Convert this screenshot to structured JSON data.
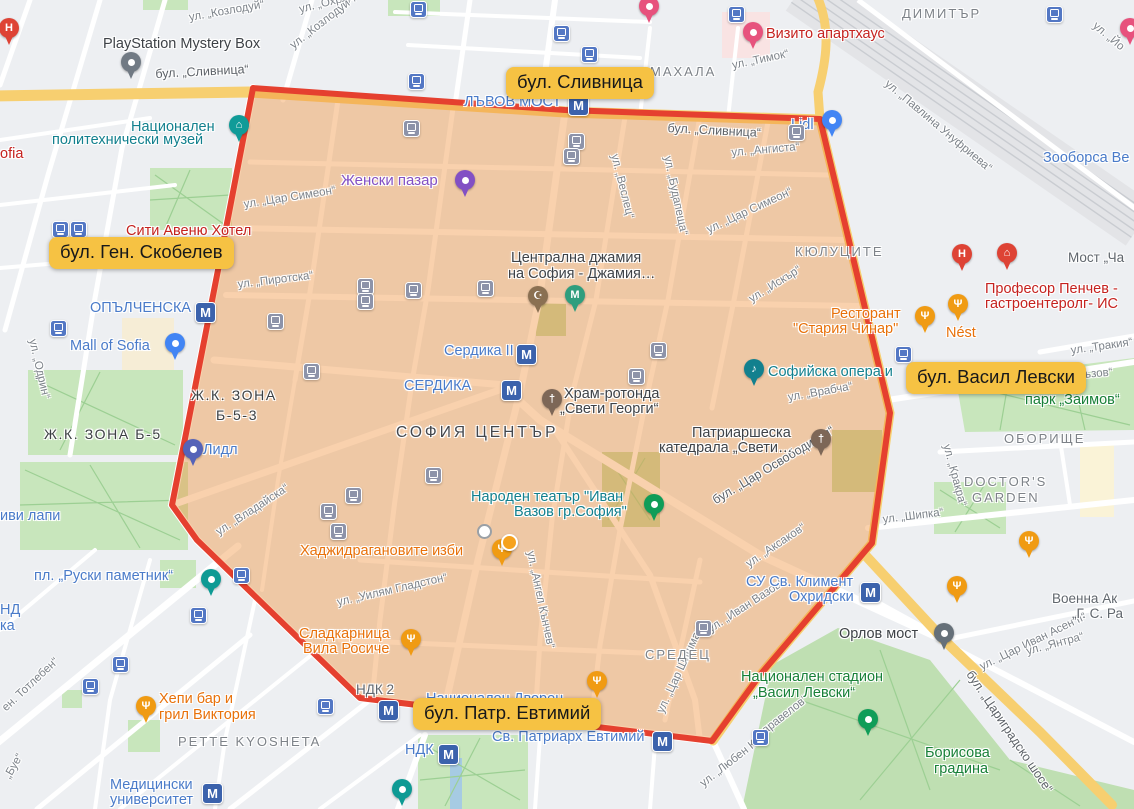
{
  "colors": {
    "zone_fill": "rgba(241,146,60,0.42)",
    "zone_border": "#e5402f",
    "annotation_bg": "#f6c243",
    "annotation_text": "#17181a",
    "road_yellow": "#f7cf70",
    "park_green": "#c8e6bc",
    "metro_blue": "#3b62ac"
  },
  "annotations": [
    {
      "t": "бул. Сливница",
      "x": 506,
      "y": 67
    },
    {
      "t": "бул. Ген. Скобелев",
      "x": 49,
      "y": 237
    },
    {
      "t": "бул. Васил Левски",
      "x": 906,
      "y": 362
    },
    {
      "t": "бул. Патр. Евтимий",
      "x": 413,
      "y": 698
    }
  ],
  "map_labels": [
    {
      "t": "ул. „Козлодуй“",
      "x": 188,
      "y": 12,
      "r": -10,
      "c": "c-st"
    },
    {
      "t": "ул. „Охрид“",
      "x": 298,
      "y": 4,
      "r": -14,
      "c": "c-st"
    },
    {
      "t": "ул. „Козлодуй“",
      "x": 288,
      "y": 42,
      "r": -38,
      "c": "c-st"
    },
    {
      "t": "ул. „Тимок“",
      "x": 731,
      "y": 60,
      "r": -12,
      "c": "c-st"
    },
    {
      "t": "ул. „Йо",
      "x": 1098,
      "y": 20,
      "r": 40,
      "c": "c-st"
    },
    {
      "t": "ул. „Павлина Унуфриева“",
      "x": 890,
      "y": 78,
      "r": 40,
      "c": "c-st"
    },
    {
      "t": "ул. „Ангиста“",
      "x": 731,
      "y": 147,
      "r": -5,
      "c": "c-st"
    },
    {
      "t": "ул. „Цар Симеон“",
      "x": 243,
      "y": 199,
      "r": -9,
      "c": "c-st"
    },
    {
      "t": "ул. „Цар Симеон“",
      "x": 705,
      "y": 225,
      "r": -25,
      "c": "c-st"
    },
    {
      "t": "ул. „Веслец“",
      "x": 620,
      "y": 153,
      "r": 76,
      "c": "c-st"
    },
    {
      "t": "ул. „Будапеща“",
      "x": 673,
      "y": 155,
      "r": 78,
      "c": "c-st"
    },
    {
      "t": "ул. „Пиротска“",
      "x": 237,
      "y": 279,
      "r": -7,
      "c": "c-st"
    },
    {
      "t": "ул. „Одрин“",
      "x": 38,
      "y": 338,
      "r": 77,
      "c": "c-st"
    },
    {
      "t": "ул. „Врабча“",
      "x": 787,
      "y": 392,
      "r": -10,
      "c": "c-st"
    },
    {
      "t": "ул. „Искър“",
      "x": 747,
      "y": 295,
      "r": -32,
      "c": "c-st"
    },
    {
      "t": "ул. „Тракия“",
      "x": 1070,
      "y": 345,
      "r": -8,
      "c": "c-st"
    },
    {
      "t": "акъзов“",
      "x": 1072,
      "y": 370,
      "r": -5,
      "c": "c-st"
    },
    {
      "t": "ул. „Кракра“",
      "x": 952,
      "y": 443,
      "r": 75,
      "c": "c-st"
    },
    {
      "t": "ул. „Шипка“",
      "x": 882,
      "y": 514,
      "r": -7,
      "c": "c-st"
    },
    {
      "t": "ул. „Аксаков“",
      "x": 744,
      "y": 560,
      "r": -34,
      "c": "c-st"
    },
    {
      "t": "ул. „Иван Вазов“",
      "x": 706,
      "y": 625,
      "r": -33,
      "c": "c-st"
    },
    {
      "t": "ул. „Цар Шишман“",
      "x": 655,
      "y": 710,
      "r": -65,
      "c": "c-st"
    },
    {
      "t": "ул. „Ангел Кънчев“",
      "x": 536,
      "y": 550,
      "r": 78,
      "c": "c-st"
    },
    {
      "t": "ул. „Уилям Гладстон“",
      "x": 336,
      "y": 597,
      "r": -13,
      "c": "c-st"
    },
    {
      "t": "ен. Тотлебен“",
      "x": 0,
      "y": 705,
      "r": -43,
      "c": "c-st"
    },
    {
      "t": "„Буе“",
      "x": 2,
      "y": 775,
      "r": -60,
      "c": "c-st"
    },
    {
      "t": "ул. „Владайска“",
      "x": 214,
      "y": 528,
      "r": -33,
      "c": "c-st"
    },
    {
      "t": "ул. „Любен Ка",
      "x": 698,
      "y": 780,
      "r": -38,
      "c": "c-st"
    },
    {
      "t": "аравелов“",
      "x": 760,
      "y": 727,
      "r": -38,
      "c": "c-st"
    },
    {
      "t": "ул. „Цар Иван Асен II“",
      "x": 978,
      "y": 662,
      "r": -26,
      "c": "c-st"
    },
    {
      "t": "ул. „Янтра“",
      "x": 1025,
      "y": 646,
      "r": -15,
      "c": "c-st"
    },
    {
      "t": "бул. „Сливница“",
      "x": 155,
      "y": 67,
      "r": -3,
      "c": "c-rd"
    },
    {
      "t": "бул. „Сливница“",
      "x": 668,
      "y": 121,
      "r": 3,
      "c": "c-rd"
    },
    {
      "t": "бул. „Цар Освободител“",
      "x": 710,
      "y": 495,
      "r": -31,
      "c": "c-rd"
    },
    {
      "t": "бул. „Цариградско шосе“",
      "x": 975,
      "y": 668,
      "r": 56,
      "c": "c-rd"
    },
    {
      "t": "МАХАЛА",
      "x": 650,
      "y": 64,
      "r": 0,
      "c": "c-ar"
    },
    {
      "t": "ДИМИТЪР",
      "x": 902,
      "y": 6,
      "r": 0,
      "c": "c-ar"
    },
    {
      "t": "КЮЛУЦИТЕ",
      "x": 795,
      "y": 244,
      "r": 0,
      "c": "c-ar"
    },
    {
      "t": "СРЕДЕЦ",
      "x": 645,
      "y": 647,
      "r": 0,
      "c": "c-ar"
    },
    {
      "t": "ОБОРИЩЕ",
      "x": 1004,
      "y": 431,
      "r": 0,
      "c": "c-ar"
    },
    {
      "t": "PETTE KYOSHETA",
      "x": 178,
      "y": 734,
      "r": 0,
      "c": "c-ar"
    },
    {
      "t": "DOCTOR'S",
      "x": 964,
      "y": 474,
      "r": 0,
      "c": "c-ar"
    },
    {
      "t": "GARDEN",
      "x": 972,
      "y": 490,
      "r": 0,
      "c": "c-ar"
    },
    {
      "t": "Ж.К. ЗОНА Б-5",
      "x": 44,
      "y": 426,
      "r": 0,
      "c": "c-ar2"
    },
    {
      "t": "Ж.К. ЗОНА",
      "x": 191,
      "y": 387,
      "r": 0,
      "c": "c-ar2"
    },
    {
      "t": "Б-5-3",
      "x": 216,
      "y": 407,
      "r": 0,
      "c": "c-ar2"
    },
    {
      "t": "СОФИЯ ЦЕНТЪР",
      "x": 396,
      "y": 424,
      "r": 0,
      "c": "c-big"
    },
    {
      "t": "Мост „Ча",
      "x": 1068,
      "y": 250,
      "r": 0,
      "c": "c-ins"
    },
    {
      "t": "Военна Ак",
      "x": 1052,
      "y": 591,
      "r": 0,
      "c": "c-ins"
    },
    {
      "t": "„Г. С. Ра",
      "x": 1072,
      "y": 606,
      "r": 0,
      "c": "c-ins"
    },
    {
      "t": "НДК 2",
      "x": 356,
      "y": 682,
      "r": 0,
      "c": "c-ins"
    },
    {
      "t": "ЛЪВОВ МОСТ",
      "x": 464,
      "y": 94,
      "r": 0,
      "c": "c-bl"
    },
    {
      "t": "ОПЪЛЧЕНСКА",
      "x": 90,
      "y": 300,
      "r": 0,
      "c": "c-bl"
    },
    {
      "t": "Сердика II",
      "x": 444,
      "y": 343,
      "r": 0,
      "c": "c-bl"
    },
    {
      "t": "СЕРДИКА",
      "x": 404,
      "y": 378,
      "r": 0,
      "c": "c-bl"
    },
    {
      "t": "Mall of Sofia",
      "x": 70,
      "y": 338,
      "r": 0,
      "c": "c-bl"
    },
    {
      "t": "Лидл",
      "x": 203,
      "y": 442,
      "r": 0,
      "c": "c-bl"
    },
    {
      "t": "иви лапи",
      "x": 0,
      "y": 508,
      "r": 0,
      "c": "c-bl"
    },
    {
      "t": "пл. „Руски паметник“",
      "x": 34,
      "y": 568,
      "r": 0,
      "c": "c-bl"
    },
    {
      "t": "НД",
      "x": 0,
      "y": 602,
      "r": 0,
      "c": "c-bl"
    },
    {
      "t": "ка",
      "x": 0,
      "y": 618,
      "r": 0,
      "c": "c-bl"
    },
    {
      "t": "Медицински",
      "x": 110,
      "y": 777,
      "r": 0,
      "c": "c-bl"
    },
    {
      "t": "университет",
      "x": 110,
      "y": 792,
      "r": 0,
      "c": "c-bl"
    },
    {
      "t": "НДК",
      "x": 405,
      "y": 742,
      "r": 0,
      "c": "c-bl"
    },
    {
      "t": "Св. Патриарх Евтимий",
      "x": 492,
      "y": 729,
      "r": 0,
      "c": "c-bl"
    },
    {
      "t": "Национален Дворец",
      "x": 426,
      "y": 691,
      "r": 0,
      "c": "c-bl"
    },
    {
      "t": "СУ Св. Климент",
      "x": 746,
      "y": 574,
      "r": 0,
      "c": "c-bl"
    },
    {
      "t": "Охридски",
      "x": 789,
      "y": 589,
      "r": 0,
      "c": "c-bl"
    },
    {
      "t": "Зооборса Ве",
      "x": 1043,
      "y": 150,
      "r": 0,
      "c": "c-bl"
    },
    {
      "t": "Lidl",
      "x": 791,
      "y": 117,
      "r": 0,
      "c": "c-bl"
    },
    {
      "t": "Национален",
      "x": 131,
      "y": 119,
      "r": 0,
      "c": "c-tl"
    },
    {
      "t": "политехнически музей",
      "x": 52,
      "y": 132,
      "r": 0,
      "c": "c-tl"
    },
    {
      "t": "Софийска опера и",
      "x": 768,
      "y": 364,
      "r": 0,
      "c": "c-tl"
    },
    {
      "t": "Народен театър \"Иван",
      "x": 471,
      "y": 489,
      "r": 0,
      "c": "c-tl"
    },
    {
      "t": "Вазов гр.София\"",
      "x": 514,
      "y": 504,
      "r": 0,
      "c": "c-tl"
    },
    {
      "t": "ofia",
      "x": 0,
      "y": 146,
      "r": 0,
      "c": "c-rd2"
    },
    {
      "t": "Сити Авеню Хотел",
      "x": 126,
      "y": 223,
      "r": 0,
      "c": "c-rd2"
    },
    {
      "t": "Визито апартхаус",
      "x": 766,
      "y": 26,
      "r": 0,
      "c": "c-rd2"
    },
    {
      "t": "Професор Пенчев -",
      "x": 985,
      "y": 281,
      "r": 0,
      "c": "c-rd2"
    },
    {
      "t": "гастроентеролг- ИС",
      "x": 985,
      "y": 296,
      "r": 0,
      "c": "c-rd2"
    },
    {
      "t": "Ресторант",
      "x": 831,
      "y": 306,
      "r": 0,
      "c": "c-or"
    },
    {
      "t": "\"Стария Чинар\"",
      "x": 793,
      "y": 321,
      "r": 0,
      "c": "c-or"
    },
    {
      "t": "Nést",
      "x": 946,
      "y": 325,
      "r": 0,
      "c": "c-or"
    },
    {
      "t": "Хаджидрагановите изби",
      "x": 300,
      "y": 543,
      "r": 0,
      "c": "c-or"
    },
    {
      "t": "Сладкарница",
      "x": 299,
      "y": 626,
      "r": 0,
      "c": "c-or"
    },
    {
      "t": "Вила Росиче",
      "x": 303,
      "y": 641,
      "r": 0,
      "c": "c-or"
    },
    {
      "t": "Хепи бар и",
      "x": 159,
      "y": 691,
      "r": 0,
      "c": "c-or"
    },
    {
      "t": "грил Виктория",
      "x": 159,
      "y": 707,
      "r": 0,
      "c": "c-or"
    },
    {
      "t": "Женски пазар",
      "x": 341,
      "y": 172,
      "r": 0,
      "c": "c-pu"
    },
    {
      "t": "парк „Заимов“",
      "x": 1025,
      "y": 392,
      "r": 0,
      "c": "c-gr"
    },
    {
      "t": "Национален стадион",
      "x": 741,
      "y": 669,
      "r": 0,
      "c": "c-gr"
    },
    {
      "t": "„Васил Левски“",
      "x": 753,
      "y": 685,
      "r": 0,
      "c": "c-gr"
    },
    {
      "t": "Борисова",
      "x": 925,
      "y": 745,
      "r": 0,
      "c": "c-gr"
    },
    {
      "t": "градина",
      "x": 934,
      "y": 761,
      "r": 0,
      "c": "c-gr"
    },
    {
      "t": "PlayStation Mystery Box",
      "x": 103,
      "y": 36,
      "r": 0,
      "c": "c-dk"
    },
    {
      "t": "Централна джамия",
      "x": 511,
      "y": 250,
      "r": 0,
      "c": "c-dk"
    },
    {
      "t": "на София - Джамия…",
      "x": 508,
      "y": 266,
      "r": 0,
      "c": "c-dk"
    },
    {
      "t": "Храм-ротонда",
      "x": 564,
      "y": 386,
      "r": 0,
      "c": "c-dk"
    },
    {
      "t": "„Свети Георги“",
      "x": 560,
      "y": 401,
      "r": 0,
      "c": "c-dk"
    },
    {
      "t": "Патриаршеска",
      "x": 692,
      "y": 425,
      "r": 0,
      "c": "c-dk"
    },
    {
      "t": "катедрала „Свети…",
      "x": 659,
      "y": 440,
      "r": 0,
      "c": "c-dk"
    },
    {
      "t": "Орлов мост",
      "x": 839,
      "y": 626,
      "r": 0,
      "c": "c-dk"
    }
  ],
  "metro_icons": [
    {
      "x": 568,
      "y": 95
    },
    {
      "x": 195,
      "y": 302
    },
    {
      "x": 516,
      "y": 344
    },
    {
      "x": 501,
      "y": 380
    },
    {
      "x": 860,
      "y": 582
    },
    {
      "x": 652,
      "y": 731
    },
    {
      "x": 438,
      "y": 744
    },
    {
      "x": 202,
      "y": 783
    },
    {
      "x": 378,
      "y": 700
    }
  ],
  "tram_icons": [
    {
      "x": 52,
      "y": 221
    },
    {
      "x": 70,
      "y": 221
    },
    {
      "x": 50,
      "y": 320
    },
    {
      "x": 408,
      "y": 73
    },
    {
      "x": 410,
      "y": 1
    },
    {
      "x": 553,
      "y": 25
    },
    {
      "x": 581,
      "y": 46
    },
    {
      "x": 728,
      "y": 6
    },
    {
      "x": 1046,
      "y": 6
    },
    {
      "x": 895,
      "y": 346
    },
    {
      "x": 112,
      "y": 656
    },
    {
      "x": 82,
      "y": 678
    },
    {
      "x": 190,
      "y": 607
    },
    {
      "x": 233,
      "y": 567
    },
    {
      "x": 317,
      "y": 698
    },
    {
      "x": 752,
      "y": 729
    },
    {
      "x": 403,
      "y": 120,
      "m": 1
    },
    {
      "x": 568,
      "y": 133,
      "m": 1
    },
    {
      "x": 563,
      "y": 148,
      "m": 1
    },
    {
      "x": 788,
      "y": 124,
      "m": 1
    },
    {
      "x": 357,
      "y": 278,
      "m": 1
    },
    {
      "x": 357,
      "y": 293,
      "m": 1
    },
    {
      "x": 405,
      "y": 282,
      "m": 1
    },
    {
      "x": 267,
      "y": 313,
      "m": 1
    },
    {
      "x": 303,
      "y": 363,
      "m": 1
    },
    {
      "x": 345,
      "y": 487,
      "m": 1
    },
    {
      "x": 320,
      "y": 503,
      "m": 1
    },
    {
      "x": 330,
      "y": 523,
      "m": 1
    },
    {
      "x": 425,
      "y": 467,
      "m": 1
    },
    {
      "x": 477,
      "y": 280,
      "m": 1
    },
    {
      "x": 650,
      "y": 342,
      "m": 1
    },
    {
      "x": 628,
      "y": 368,
      "m": 1
    },
    {
      "x": 695,
      "y": 620,
      "m": 1
    }
  ],
  "pins": [
    {
      "x": 9,
      "y": 46,
      "col": "#de4335",
      "g": "H",
      "name": "hospital-pin"
    },
    {
      "x": 131,
      "y": 80,
      "col": "#717a84",
      "g": "•",
      "name": "store-pin"
    },
    {
      "x": 239,
      "y": 143,
      "col": "#109b98",
      "g": "⌂",
      "name": "museum-pin"
    },
    {
      "x": 465,
      "y": 198,
      "col": "#8250c4",
      "g": "•",
      "name": "market-pin"
    },
    {
      "x": 649,
      "y": 24,
      "col": "#e7527d",
      "g": "•",
      "name": "hotel-pin"
    },
    {
      "x": 753,
      "y": 50,
      "col": "#e7527d",
      "g": "•",
      "name": "hotel-pin"
    },
    {
      "x": 1130,
      "y": 46,
      "col": "#e7527d",
      "g": "•",
      "name": "hotel-pin"
    },
    {
      "x": 832,
      "y": 138,
      "col": "#4285f4",
      "g": "•",
      "name": "supermarket-pin"
    },
    {
      "x": 962,
      "y": 272,
      "col": "#de4335",
      "g": "H",
      "name": "hospital-pin"
    },
    {
      "x": 1007,
      "y": 271,
      "col": "#de4335",
      "g": "⌂",
      "name": "clinic-pin"
    },
    {
      "x": 538,
      "y": 314,
      "col": "#8a7052",
      "g": "☪",
      "name": "mosque-pin"
    },
    {
      "x": 575,
      "y": 313,
      "col": "#2f9e7e",
      "g": "М",
      "name": "museum-pin"
    },
    {
      "x": 552,
      "y": 417,
      "col": "#7d6757",
      "g": "†",
      "name": "church-pin"
    },
    {
      "x": 821,
      "y": 457,
      "col": "#7d6757",
      "g": "†",
      "name": "cathedral-pin"
    },
    {
      "x": 754,
      "y": 387,
      "col": "#12808e",
      "g": "♪",
      "name": "opera-pin"
    },
    {
      "x": 654,
      "y": 522,
      "col": "#0f9d58",
      "g": "•",
      "name": "theatre-pin"
    },
    {
      "x": 925,
      "y": 334,
      "col": "#f09b13",
      "g": "Ψ",
      "name": "restaurant-pin"
    },
    {
      "x": 958,
      "y": 322,
      "col": "#f09b13",
      "g": "Ψ",
      "name": "restaurant-pin"
    },
    {
      "x": 502,
      "y": 567,
      "col": "#f09b13",
      "g": "Ψ",
      "name": "restaurant-pin"
    },
    {
      "x": 411,
      "y": 657,
      "col": "#f09b13",
      "g": "Ψ",
      "name": "restaurant-pin"
    },
    {
      "x": 146,
      "y": 724,
      "col": "#f09b13",
      "g": "Ψ",
      "name": "restaurant-pin"
    },
    {
      "x": 597,
      "y": 699,
      "col": "#f09b13",
      "g": "Ψ",
      "name": "restaurant-pin"
    },
    {
      "x": 957,
      "y": 604,
      "col": "#f09b13",
      "g": "Ψ",
      "name": "restaurant-pin"
    },
    {
      "x": 1029,
      "y": 559,
      "col": "#f09b13",
      "g": "Ψ",
      "name": "restaurant-pin"
    },
    {
      "x": 175,
      "y": 361,
      "col": "#4285f4",
      "g": "•",
      "name": "mall-pin"
    },
    {
      "x": 193,
      "y": 467,
      "col": "#5563b8",
      "g": "•",
      "name": "supermarket-pin"
    },
    {
      "x": 211,
      "y": 597,
      "col": "#0e9a94",
      "g": "•",
      "name": "monument-pin"
    },
    {
      "x": 944,
      "y": 651,
      "col": "#667079",
      "g": "•",
      "name": "bridge-pin"
    },
    {
      "x": 868,
      "y": 737,
      "col": "#0f9d58",
      "g": "•",
      "name": "picnic-pin"
    },
    {
      "x": 402,
      "y": 807,
      "col": "#0e9a94",
      "g": "•",
      "name": "university-pin"
    }
  ],
  "dots": [
    {
      "x": 484,
      "y": 531,
      "type": "white"
    },
    {
      "x": 508,
      "y": 541,
      "type": "orange"
    }
  ]
}
